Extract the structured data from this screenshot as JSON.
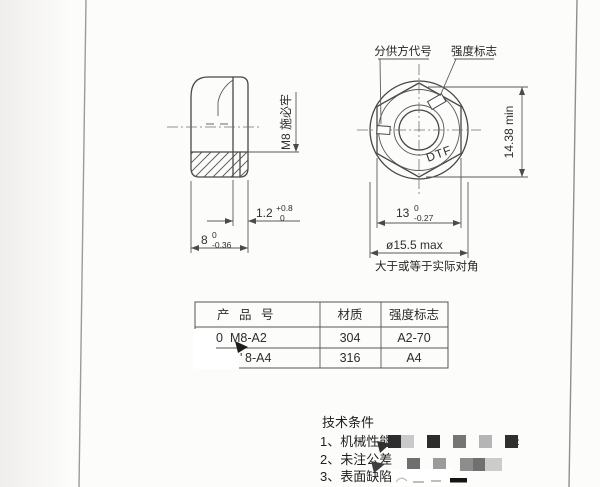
{
  "drawing": {
    "labels": {
      "supplier_code": "分供方代号",
      "strength_mark": "强度标志",
      "thread_spec": "M8 施必牢",
      "face_mark": "DTF",
      "diagonal_note": "大于或等于实际对角"
    },
    "dimensions": {
      "flange_thickness": {
        "value": "1.2",
        "tol_upper": "+0.8",
        "tol_lower": "0"
      },
      "nut_height": {
        "value": "8",
        "tol_upper": "0",
        "tol_lower": "-0.36"
      },
      "across_corners": "14.38 min",
      "across_flats": {
        "value": "13",
        "tol_upper": "0",
        "tol_lower": "-0.27"
      },
      "flange_diameter": "ø15.5 max"
    }
  },
  "table": {
    "headers": [
      "产 品 号",
      "材质",
      "强度标志"
    ],
    "rows": [
      {
        "product_prefix": "C0",
        "product": "M8-A2",
        "material": "304",
        "strength": "A2-70"
      },
      {
        "product_prefix": "'",
        "product": "8-A4",
        "material": "316",
        "strength": "A4"
      }
    ]
  },
  "tech": {
    "heading": "技术条件",
    "items": [
      "1、机械性能",
      "2、未注公差",
      "3、表面缺陷:"
    ],
    "mosaic_tail": ":",
    "mosaic_row1": [
      "#2d2d2d",
      "#c9c9c9",
      "#2d2d2d",
      "#757575",
      "#b5b5b5",
      "#2f2f2f"
    ],
    "mosaic_row2": [
      "#6f6f6f",
      "#9b9b9b",
      "#8d8d8d",
      "#707070",
      "#cccccc"
    ]
  },
  "colors": {
    "paper": "#fcfcfb",
    "line": "#474747",
    "text": "#2c2c2c",
    "redaction_white": "#ffffff",
    "cursor": "#1c1c1c"
  }
}
